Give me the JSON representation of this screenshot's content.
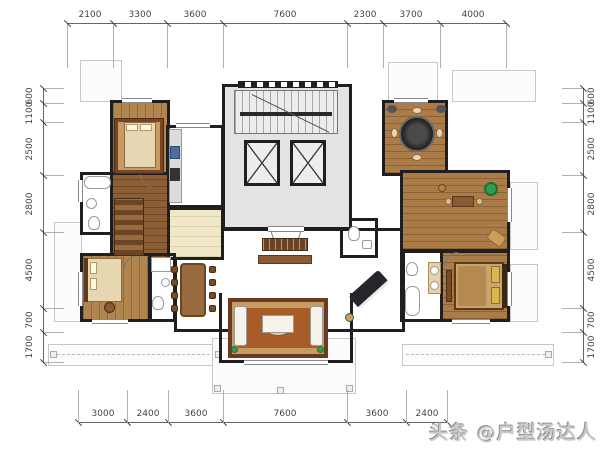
{
  "watermark": {
    "text": "头条 @户型汤达人"
  },
  "dimensions": {
    "top": [
      "2100",
      "3300",
      "3600",
      "7600",
      "2300",
      "3700",
      "4000"
    ],
    "bottom": [
      "3000",
      "2400",
      "3600",
      "7600",
      "3600",
      "2400"
    ],
    "left": [
      "600",
      "1100",
      "2500",
      "2800",
      "4500",
      "700",
      "1700"
    ],
    "right": [
      "600",
      "1100",
      "2500",
      "2800",
      "4500",
      "700",
      "1700"
    ]
  },
  "colors": {
    "wall": "#1f1f1f",
    "wood_floor": "#b1854f",
    "dark_wood_floor": "#8b5e35",
    "tile_floor": "#eae0bd",
    "warm_tile_floor": "#f2dfa9",
    "core_gray": "#e3e3e3",
    "carpet_field": "#a85c28",
    "carpet_border": "#6c3a1e",
    "plant_green": "#2e9e4e",
    "piano_black": "#26262a",
    "dimension_text": "#444444",
    "watermark_gray": "#c9c9c9"
  }
}
